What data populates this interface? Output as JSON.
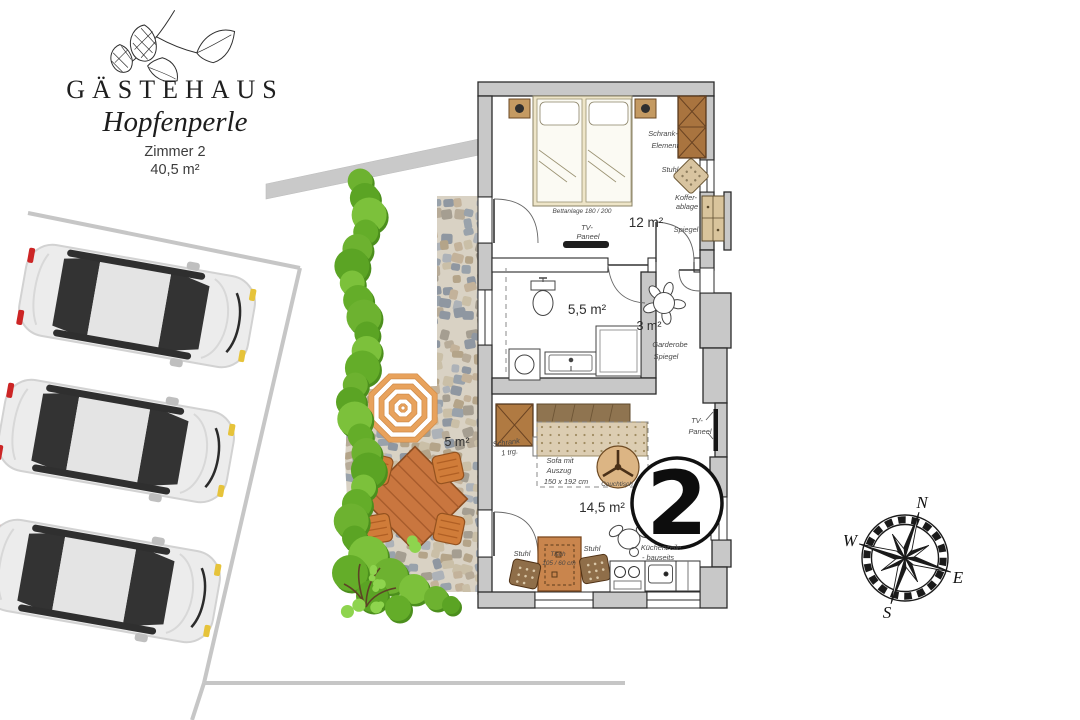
{
  "colors": {
    "wall": "#c8c8c8",
    "hedge": "#6db230",
    "parasol": "#e8a25c",
    "terrace_wood": "#c9763f",
    "furniture_brown": "#a9743f"
  },
  "logo": {
    "title": "GÄSTEHAUS",
    "subtitle": "Hopfenperle",
    "room": "Zimmer 2",
    "total_area": "40,5 m²"
  },
  "unit_badge": "2",
  "compass": {
    "n": "N",
    "e": "E",
    "s": "S",
    "w": "W"
  },
  "bedroom": {
    "area": "12 m²",
    "bed": "Bettanlage 180 / 200",
    "tv1": "TV-",
    "tv2": "Paneel",
    "wardrobe1": "Schrank-",
    "wardrobe2": "Element",
    "chair": "Stuhl",
    "luggage1": "Koffer-",
    "luggage2": "ablage",
    "mirror": "Spiegel"
  },
  "bathroom": {
    "area": "5,5 m²"
  },
  "hallway": {
    "area": "3 m²",
    "wardrobe": "Garderobe",
    "mirror": "Spiegel"
  },
  "living": {
    "area": "14,5 m²",
    "cabinet1": "Schrank",
    "cabinet2": "1 trg.",
    "sofa1": "Sofa mit",
    "sofa2": "Auszug",
    "sofa3": "150 x 192 cm",
    "coffee_table": "Couchtisch",
    "tv1": "TV-",
    "tv2": "Paneel",
    "chair_left": "Stuhl",
    "chair_right": "Stuhl",
    "table1": "Tisch",
    "table2": "105 / 60 cm",
    "kitchen1": "Küchenzeile",
    "kitchen2": "- bauseits"
  },
  "terrace": {
    "area": "5 m²"
  }
}
